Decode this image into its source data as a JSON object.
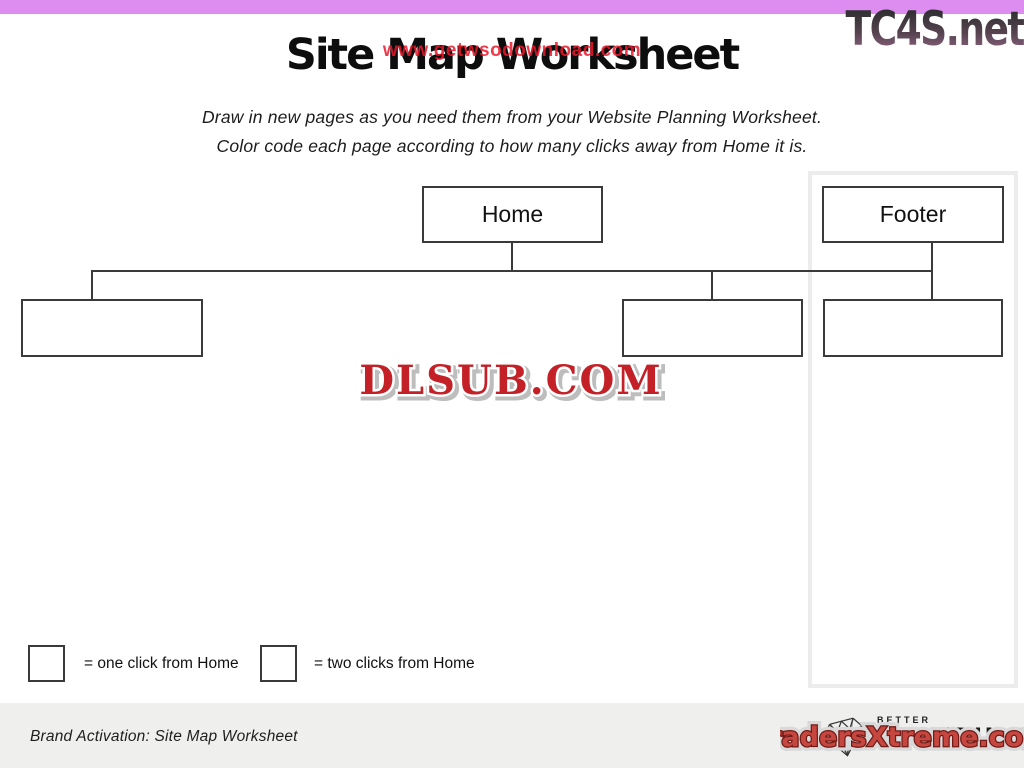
{
  "page": {
    "title": "Site Map Worksheet",
    "instructions_line1": "Draw in new pages as you need them from your Website Planning Worksheet.",
    "instructions_line2": "Color code each page according to how many clicks away from Home it is."
  },
  "watermarks": {
    "title_overlay": "www.getwsodownload.com",
    "top_right": "TC4S.net",
    "center": "DLSUB.COM",
    "bottom_right": "TradersXtreme.com"
  },
  "sitemap": {
    "nodes": [
      {
        "id": "home",
        "label": "Home",
        "level": 0
      },
      {
        "id": "footer",
        "label": "Footer",
        "level": 1
      },
      {
        "id": "child-1",
        "label": "",
        "level": 1
      },
      {
        "id": "child-2",
        "label": "",
        "level": 1
      },
      {
        "id": "child-3",
        "label": "",
        "level": 1
      }
    ]
  },
  "legend": {
    "one_click_label": "= one click from Home",
    "two_clicks_label": "= two clicks from Home"
  },
  "footer": {
    "caption": "Brand Activation: Site Map Worksheet",
    "logo_top": "BETTER",
    "logo_bottom": "BRANDING"
  },
  "colors": {
    "top_bar": "#dd8cef",
    "title_text": "#0d0d0d",
    "overlay_watermark_red": "#eb192d",
    "dlsub_red": "#c32127",
    "traders_red": "#c5473f",
    "tc4s_gradient_top": "#2f2f31",
    "tc4s_gradient_bottom": "#9a6b8e",
    "box_border": "#3a3a3a",
    "panel_border": "#ececec",
    "footer_strip": "#efefee"
  }
}
